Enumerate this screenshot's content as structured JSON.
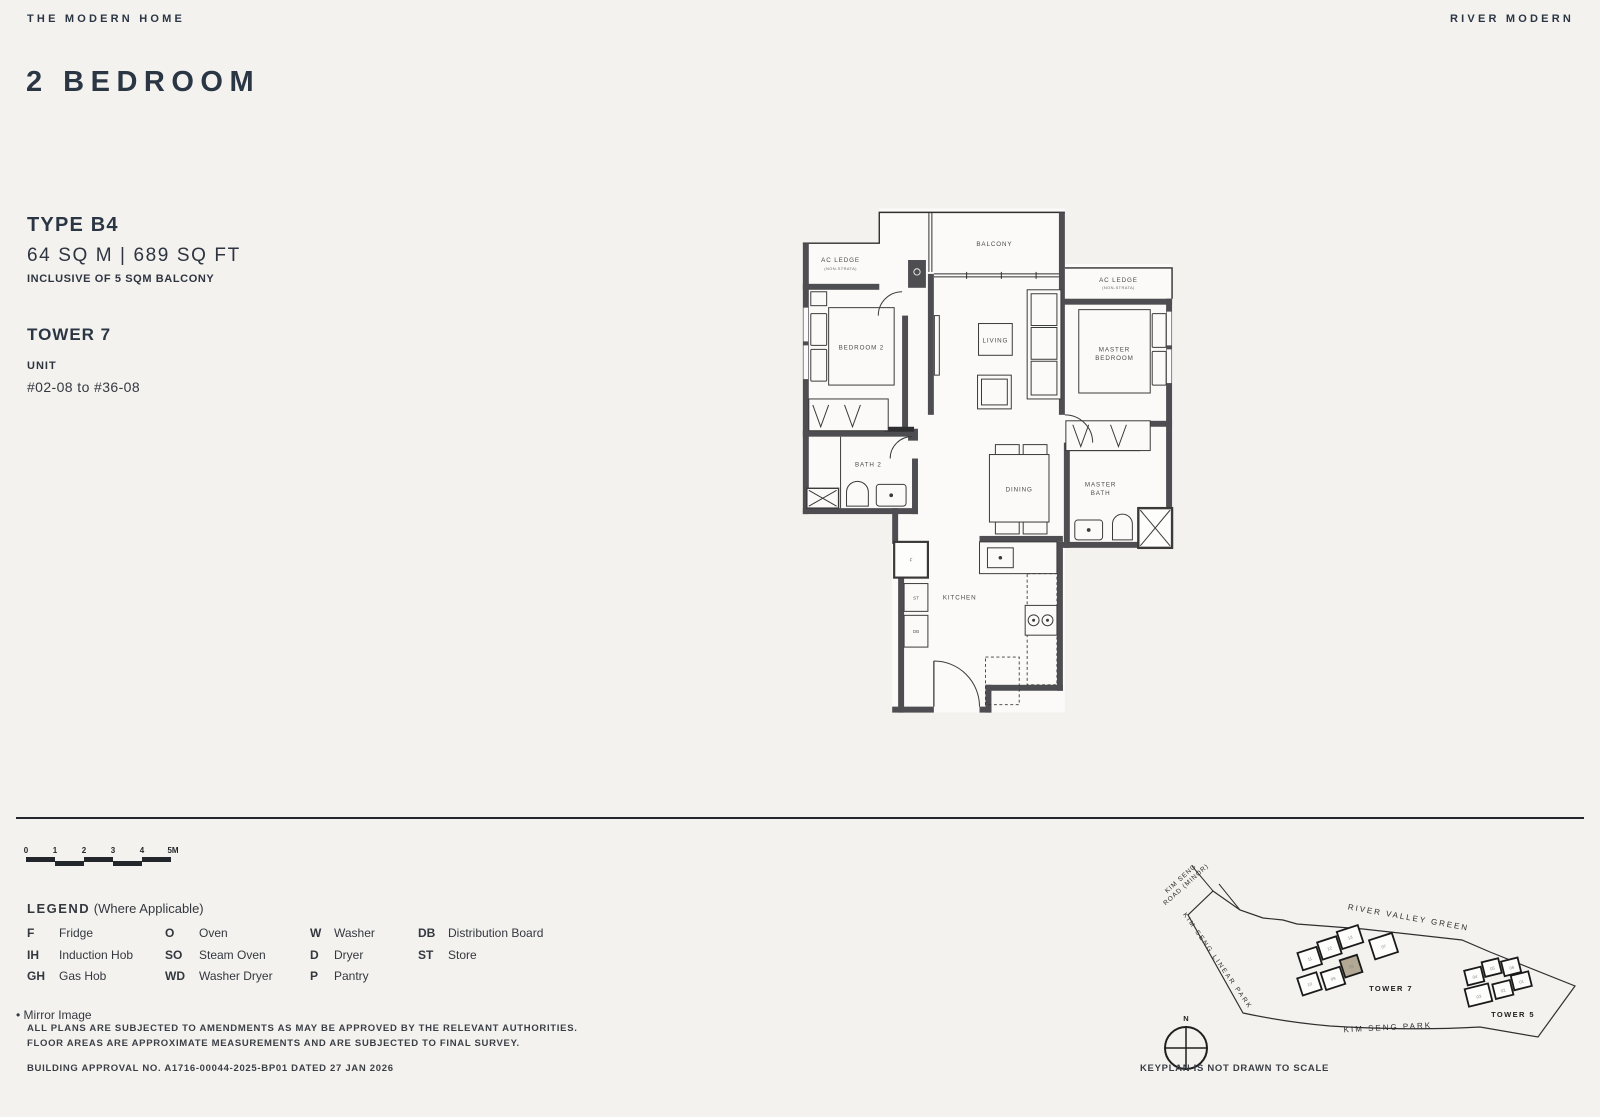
{
  "header": {
    "brand": "THE MODERN HOME",
    "project": "RIVER MODERN"
  },
  "title": "2 BEDROOM",
  "unit_info": {
    "type": "TYPE B4",
    "area": "64 SQ M | 689 SQ FT",
    "balcony_note": "INCLUSIVE OF 5 SQM BALCONY",
    "tower": "TOWER 7",
    "unit_label": "UNIT",
    "unit_range": "#02-08 to #36-08"
  },
  "floorplan": {
    "balcony": "BALCONY",
    "ac_ledge": "AC LEDGE",
    "ac_ledge_sub": "(NON-STRATA)",
    "ac_ledge_right": "AC LEDGE",
    "ac_ledge_right_sub": "(NON-STRATA)",
    "bedroom2": "BEDROOM 2",
    "living": "LIVING",
    "master_line1": "MASTER",
    "master_line2": "BEDROOM",
    "bath2": "BATH 2",
    "dining": "DINING",
    "master_bath_line1": "MASTER",
    "master_bath_line2": "BATH",
    "kitchen": "KITCHEN",
    "fridge": "F",
    "store": "ST",
    "db": "DB"
  },
  "scalebar": {
    "ticks": [
      "0",
      "1",
      "2",
      "3",
      "4",
      "5M"
    ]
  },
  "legend": {
    "title": "LEGEND",
    "subtitle": "(Where Applicable)",
    "items": [
      {
        "abbr": "F",
        "label": "Fridge"
      },
      {
        "abbr": "IH",
        "label": "Induction Hob"
      },
      {
        "abbr": "GH",
        "label": "Gas Hob"
      },
      {
        "abbr": "O",
        "label": "Oven"
      },
      {
        "abbr": "SO",
        "label": "Steam Oven"
      },
      {
        "abbr": "WD",
        "label": "Washer Dryer"
      },
      {
        "abbr": "W",
        "label": "Washer"
      },
      {
        "abbr": "D",
        "label": "Dryer"
      },
      {
        "abbr": "P",
        "label": "Pantry"
      },
      {
        "abbr": "DB",
        "label": "Distribution Board"
      },
      {
        "abbr": "ST",
        "label": "Store"
      }
    ],
    "mirror_note": "Mirror Image"
  },
  "disclaimer": {
    "line1": "ALL PLANS ARE SUBJECTED TO AMENDMENTS AS MAY BE APPROVED BY THE RELEVANT AUTHORITIES.",
    "line2": "FLOOR AREAS ARE APPROXIMATE MEASUREMENTS AND ARE SUBJECTED TO FINAL SURVEY.",
    "approval": "BUILDING APPROVAL NO. A1716-00044-2025-BP01 DATED 27 JAN 2026"
  },
  "keyplan": {
    "road_minor_line1": "KIM SENG",
    "road_minor_line2": "ROAD (MINOR)",
    "linear_park": "KIM SENG LINEAR PARK",
    "river_valley": "RIVER VALLEY GREEN",
    "kim_seng_park": "KIM SENG PARK",
    "tower7": "TOWER 7",
    "tower5": "TOWER 5",
    "tower7_units": [
      "11",
      "12",
      "13",
      "07",
      "10",
      "09",
      "08"
    ],
    "tower5_units": [
      "04",
      "05",
      "06",
      "03",
      "02",
      "01"
    ],
    "highlighted_unit": "08",
    "compass_n": "N",
    "note": "KEYPLAN IS NOT DRAWN TO SCALE"
  },
  "colors": {
    "background": "#f4f2ef",
    "heading": "#2b3644",
    "wall": "#4e4e52",
    "highlight_unit": "#b3a893"
  }
}
